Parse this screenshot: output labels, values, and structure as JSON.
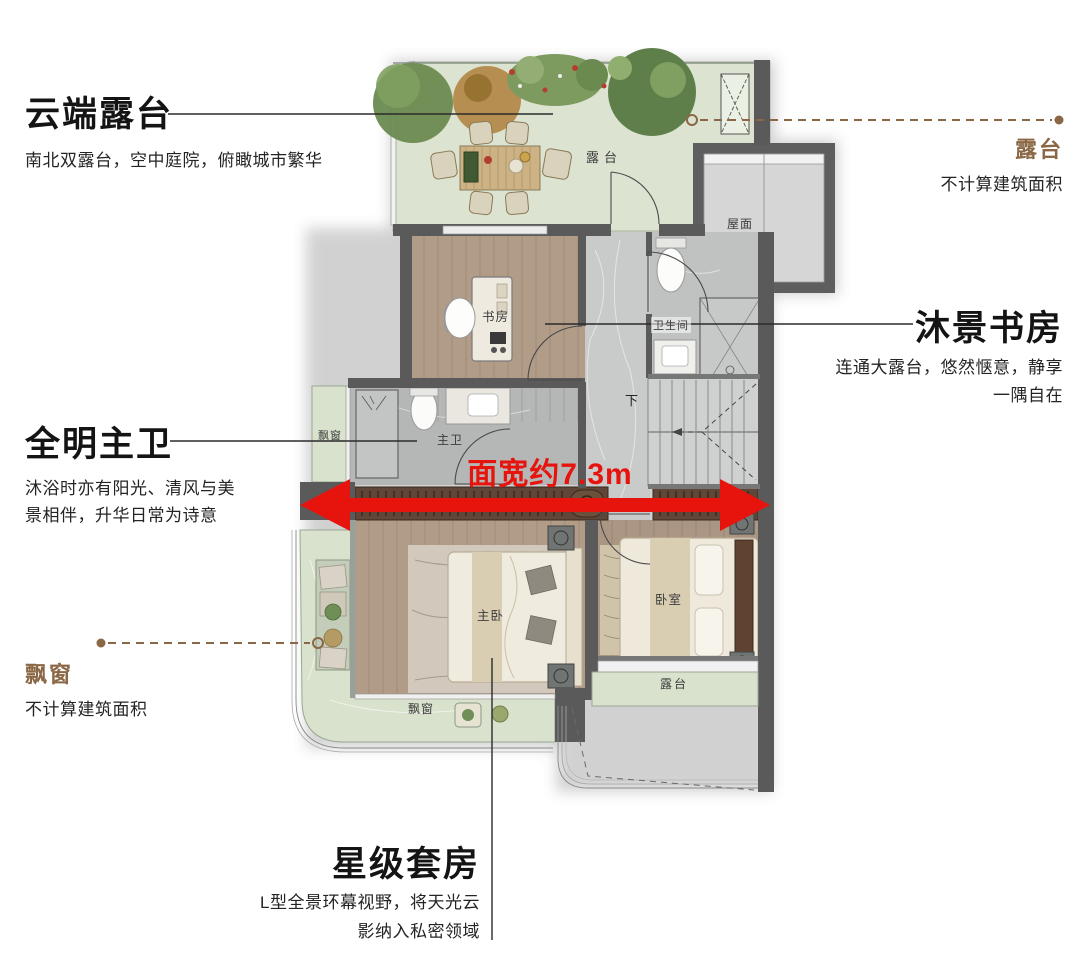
{
  "annotations": {
    "terrace_top": {
      "title": "云端露台",
      "desc": "南北双露台，空中庭院，俯瞰城市繁华"
    },
    "terrace_right": {
      "title": "露台",
      "desc": "不计算建筑面积"
    },
    "study": {
      "title": "沐景书房",
      "desc_lines": [
        "连通大露台，悠然惬意，静享",
        "一隅自在"
      ]
    },
    "master_bath": {
      "title": "全明主卫",
      "desc_lines": [
        "沐浴时亦有阳光、清风与美",
        "景相伴，升华日常为诗意"
      ]
    },
    "bay_window": {
      "title": "飘窗",
      "desc": "不计算建筑面积"
    },
    "suite": {
      "title": "星级套房",
      "desc_lines": [
        "L型全景环幕视野，将天光云",
        "影纳入私密领域"
      ]
    }
  },
  "dimension_label": "面宽约7.3m",
  "plan_labels": {
    "terrace": "露台",
    "roof": "屋面",
    "study": "书房",
    "bathroom": "卫生间",
    "master_bath": "主卫",
    "bay_left": "飘窗",
    "stairs_down": "下",
    "master_bedroom": "主卧",
    "bedroom": "卧室",
    "bay_bottom": "飘窗",
    "terrace_bottom": "露台"
  },
  "colors": {
    "accent_red": "#e7130d",
    "label_brown": "#8a6845",
    "terrace_green": "#dce4d1",
    "wood": "#b19c88",
    "wall_gray": "#5a5a5a"
  }
}
